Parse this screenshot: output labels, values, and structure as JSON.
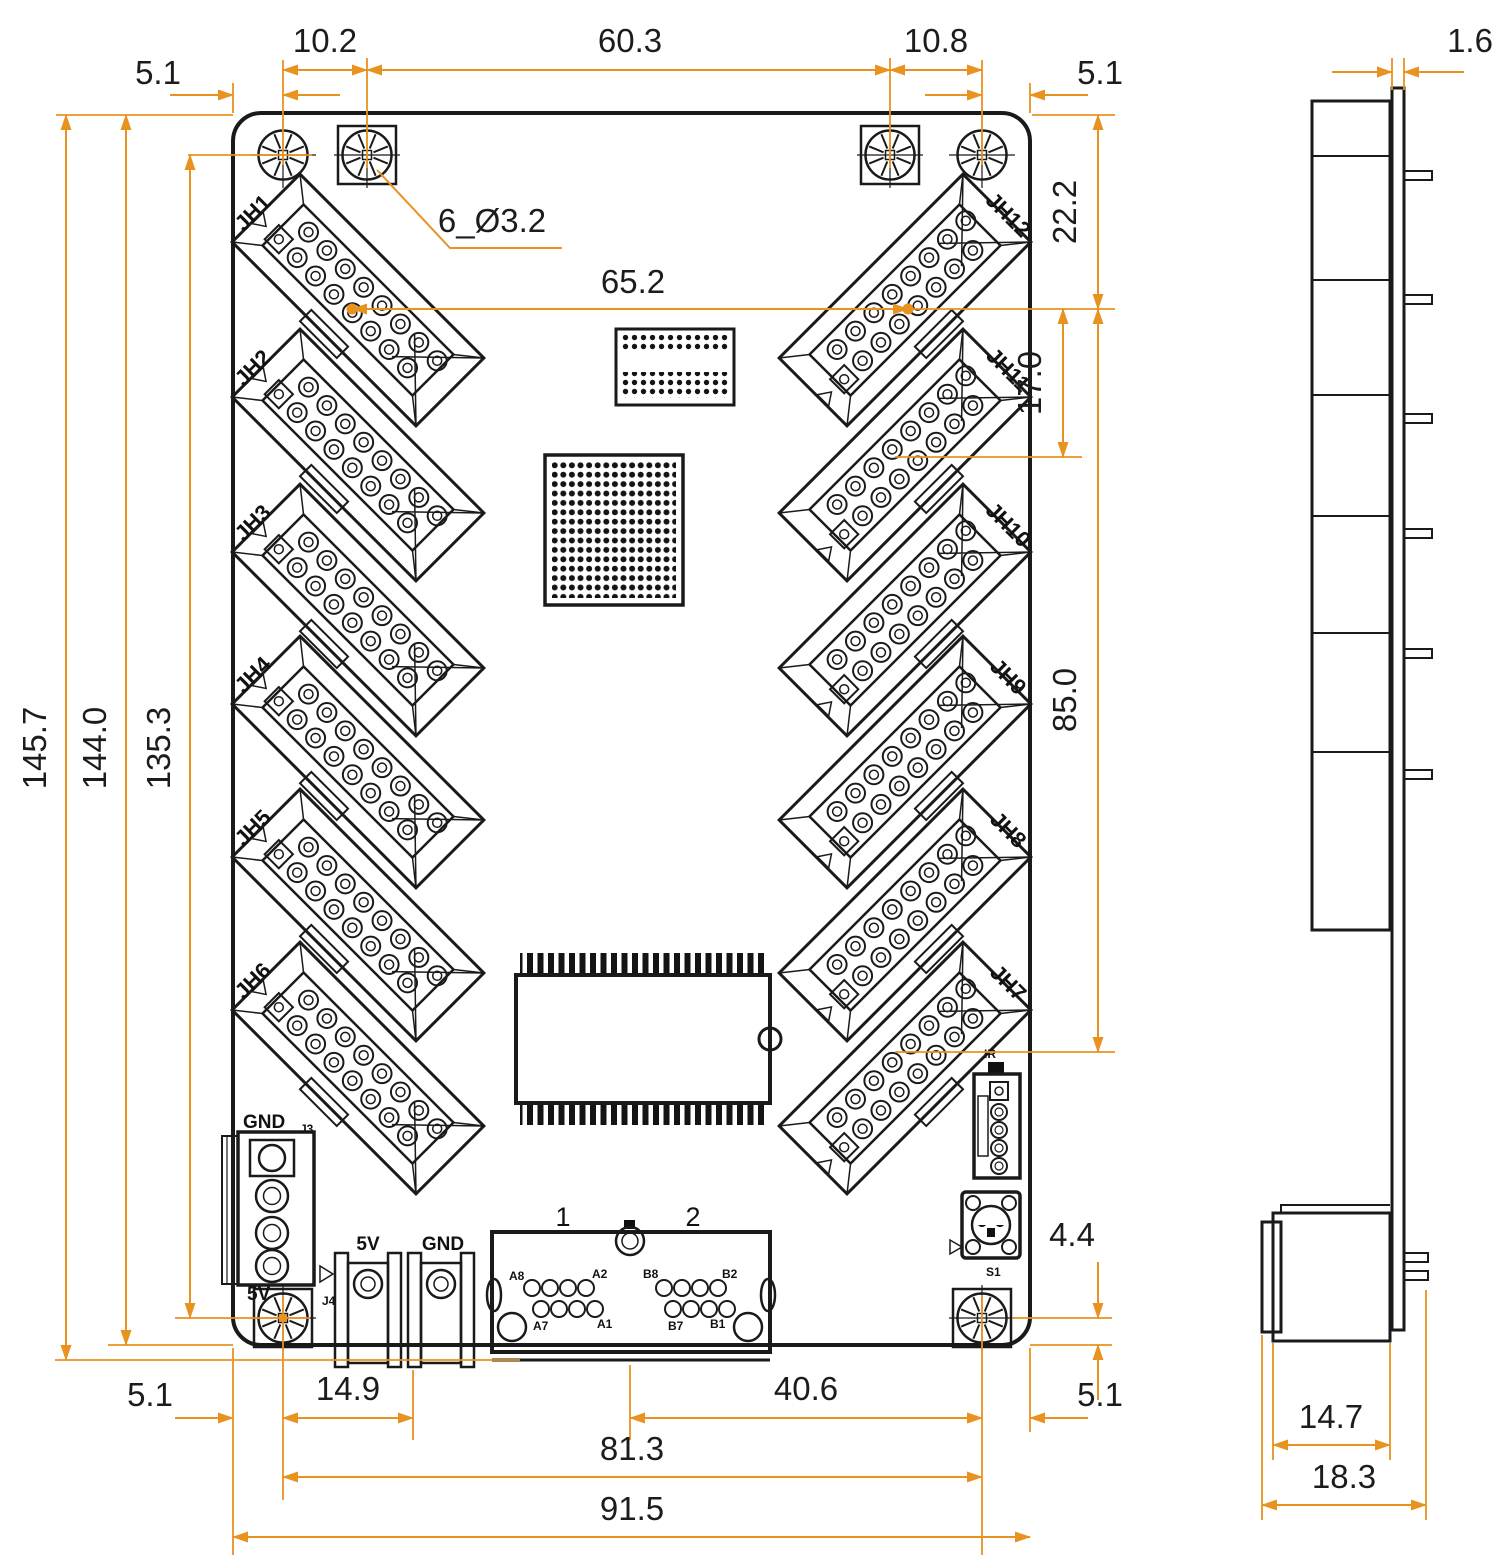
{
  "colors": {
    "line": "#1a1a1a",
    "dimension": "#e8921f",
    "background": "#ffffff"
  },
  "dims": {
    "top_left_margin": "5.1",
    "hole_pitch_left": "10.2",
    "hole_span_top": "60.3",
    "hole_pitch_right": "10.8",
    "top_right_margin": "5.1",
    "hole_note": "6_Ø3.2",
    "connector_span_h": "65.2",
    "edge_to_pin": "22.2",
    "connector_pitch": "17.0",
    "connector_span_v": "85.0",
    "overall_height": "145.7",
    "board_height": "144.0",
    "hole_span_v": "135.3",
    "bottom_left_margin": "5.1",
    "power_offset": "14.9",
    "port_to_hole": "40.6",
    "bottom_right_margin": "5.1",
    "hole_span_bottom": "81.3",
    "board_width": "91.5",
    "hole_to_edge": "4.4",
    "pcb_thickness": "1.6",
    "connector_depth": "14.7",
    "overall_depth": "18.3"
  },
  "connectors": {
    "left": [
      "JH1",
      "JH2",
      "JH3",
      "JH4",
      "JH5",
      "JH6"
    ],
    "right": [
      "JH12",
      "JH11",
      "JH10",
      "JH9",
      "JH8",
      "JH7"
    ]
  },
  "components": {
    "gnd_block_label": "GND",
    "gnd_block_ref": "J3",
    "pwr_5v_label": "5V",
    "pwr_5v_ref": "J4",
    "terminal_5v": "5V",
    "terminal_gnd": "GND",
    "port1": "1",
    "port2": "2",
    "port_pins": {
      "a8": "A8",
      "a2": "A2",
      "a7": "A7",
      "a1": "A1",
      "b8": "B8",
      "b2": "B2",
      "b7": "B7",
      "b1": "B1"
    },
    "ir_label": "IR",
    "button_ref": "S1"
  }
}
